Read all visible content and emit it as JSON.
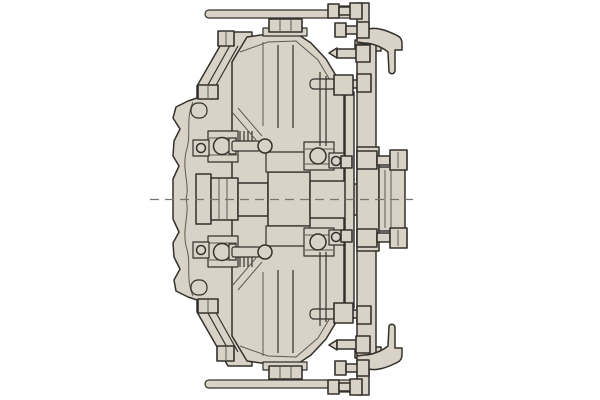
{
  "meta": {
    "description": "Engineering cross-section line drawing of a mechanical clutch coupling assembly with housing, twin drum halves, stepped central shaft, ball bearings, output flange and release-lever linkages at top and bottom"
  },
  "colors": {
    "background": "#ffffff",
    "part_fill": "#d9d2c6",
    "outline": "#33312c",
    "inner_line": "#5d5b52",
    "centerline": "#76746c"
  },
  "diagram": {
    "type": "engineering-cross-section",
    "components": [
      "left-housing",
      "upper-drum-half",
      "lower-drum-half",
      "central-shaft",
      "bearing-upper-left",
      "bearing-upper-right",
      "bearing-lower-left",
      "bearing-lower-right",
      "pressure-plate-thin",
      "pressure-plate-wide",
      "output-flange",
      "flange-bolt-top",
      "flange-bolt-bottom",
      "push-rod-top",
      "push-rod-bottom",
      "release-lever-top",
      "release-lever-bottom",
      "center-bolt-top",
      "center-bolt-bottom",
      "housing-bolts",
      "axis-centerline"
    ]
  }
}
